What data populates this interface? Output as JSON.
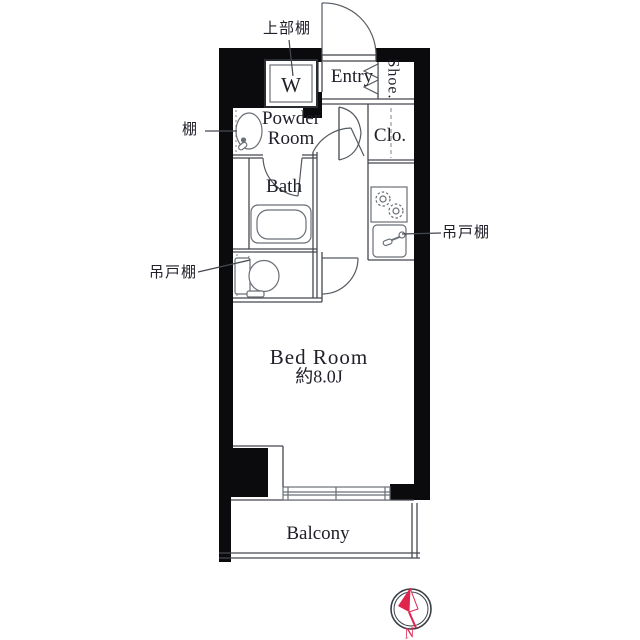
{
  "floor_plan": {
    "rooms": {
      "entry": "Entry",
      "shoe_closet": "Shoe.",
      "powder_room": "Powder Room",
      "closet": "Clo.",
      "bath": "Bath",
      "bedroom": {
        "name": "Bed Room",
        "area": "約8.0J"
      },
      "balcony": "Balcony"
    },
    "fixtures": {
      "washing_machine": "W"
    },
    "callouts": {
      "upper_shelf": "上部棚",
      "shelf": "棚",
      "hanging_cupboard_left": "吊戸棚",
      "hanging_cupboard_right": "吊戸棚"
    },
    "compass": {
      "north": "N"
    },
    "colors": {
      "wall": "#0b0b0d",
      "outline": "#44484f",
      "fixture": "#6a6f76",
      "compass_red": "#e0244e",
      "text": "#20202a",
      "background": "#ffffff"
    }
  }
}
